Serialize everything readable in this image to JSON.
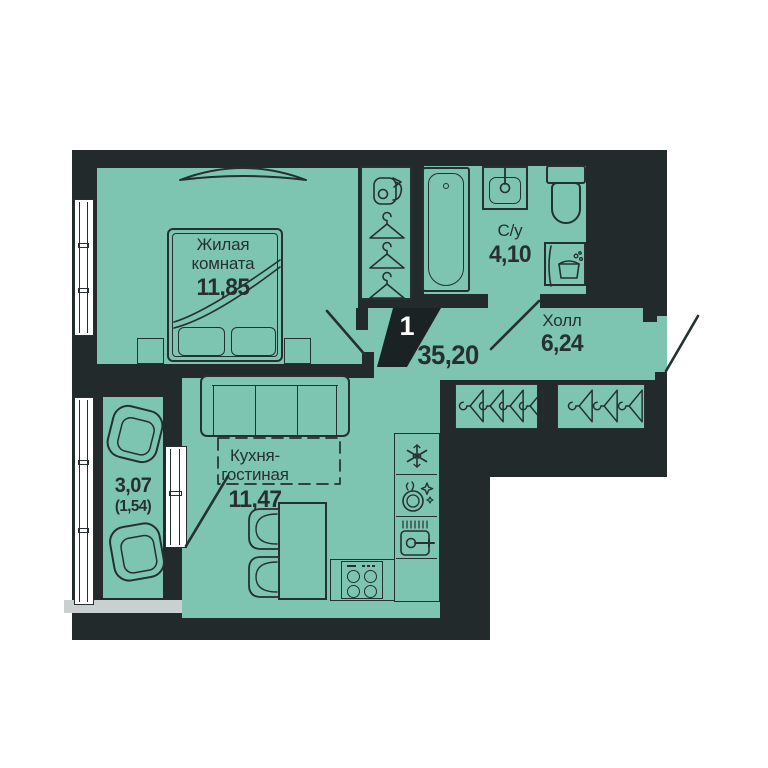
{
  "colors": {
    "wall": "#222a2b",
    "floor": "#7dc5b1",
    "text": "#273031",
    "badge_bg": "#1b2223",
    "badge_text": "#ffffff",
    "balcony_slab": "#c9d0cf"
  },
  "badge": {
    "unit_count": "1",
    "total_area": "35,20"
  },
  "rooms": {
    "living": {
      "name_lines": [
        "Жилая",
        "комната"
      ],
      "area": "11,85"
    },
    "bathroom": {
      "name": "С/у",
      "area": "4,10"
    },
    "hall": {
      "name": "Холл",
      "area": "6,24"
    },
    "kitchen": {
      "name_lines": [
        "Кухня-",
        "гостиная"
      ],
      "area": "11,47"
    },
    "balcony": {
      "area": "3,07",
      "area_coefficient": "(1,54)"
    }
  },
  "icons": {
    "fridge": "snowflake",
    "dishwasher": "plate-with-sparkles",
    "kitchen_sink": "basin-with-faucet",
    "washing_machine": "laundry-basket",
    "wardrobe": "clothes-hangers",
    "storage": "vacuum-cleaner"
  }
}
